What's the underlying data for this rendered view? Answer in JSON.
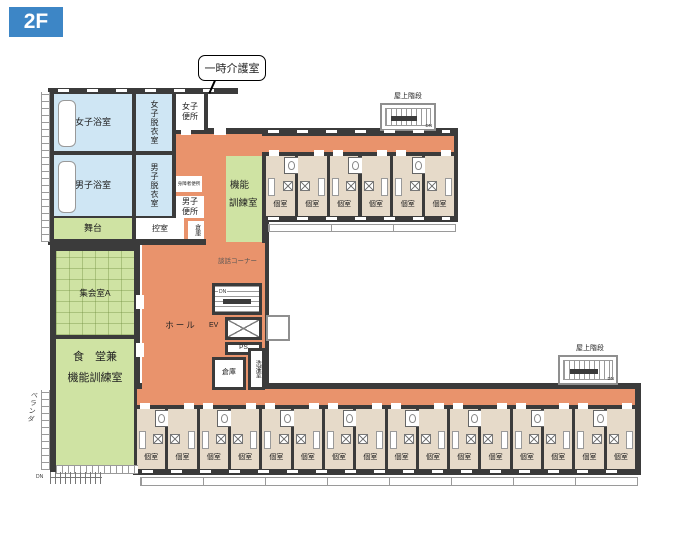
{
  "floor_badge": "2F",
  "colors": {
    "wall": "#3b3b3b",
    "corridor": "#e9936c",
    "bath_blue": "#cfe6f4",
    "room_green": "#cfe3a3",
    "room_tan": "#e6dac9",
    "badge_blue": "#3d86c6",
    "outline_gray": "#8f8f8f"
  },
  "labels": {
    "callout": "一時介護室",
    "womens_bath": "女子浴室",
    "mens_bath": "男子浴室",
    "womens_dressing": "女子脱衣室",
    "mens_dressing": "男子脱衣室",
    "womens_toilet": "女子便所",
    "mens_toilet": "男子便所",
    "accessible_toilet": "身障者便所",
    "function_line1": "機能",
    "function_line2": "訓練室",
    "stage": "舞台",
    "waiting_room": "控室",
    "storage": "倉庫",
    "laundry": "洗濯室",
    "meeting_room": "集会室A",
    "dining_line1": "食　堂兼",
    "dining_line2": "機能訓練室",
    "hall": "ホール",
    "chat_corner": "談話コーナー",
    "elevator": "EV",
    "pipe_space": "PS",
    "down": "DN",
    "roof_stairs": "屋上階段",
    "private_room": "個室",
    "veranda": "ベランダ"
  },
  "counts": {
    "top_wing_rooms": 6,
    "bottom_wing_rooms": 16
  }
}
